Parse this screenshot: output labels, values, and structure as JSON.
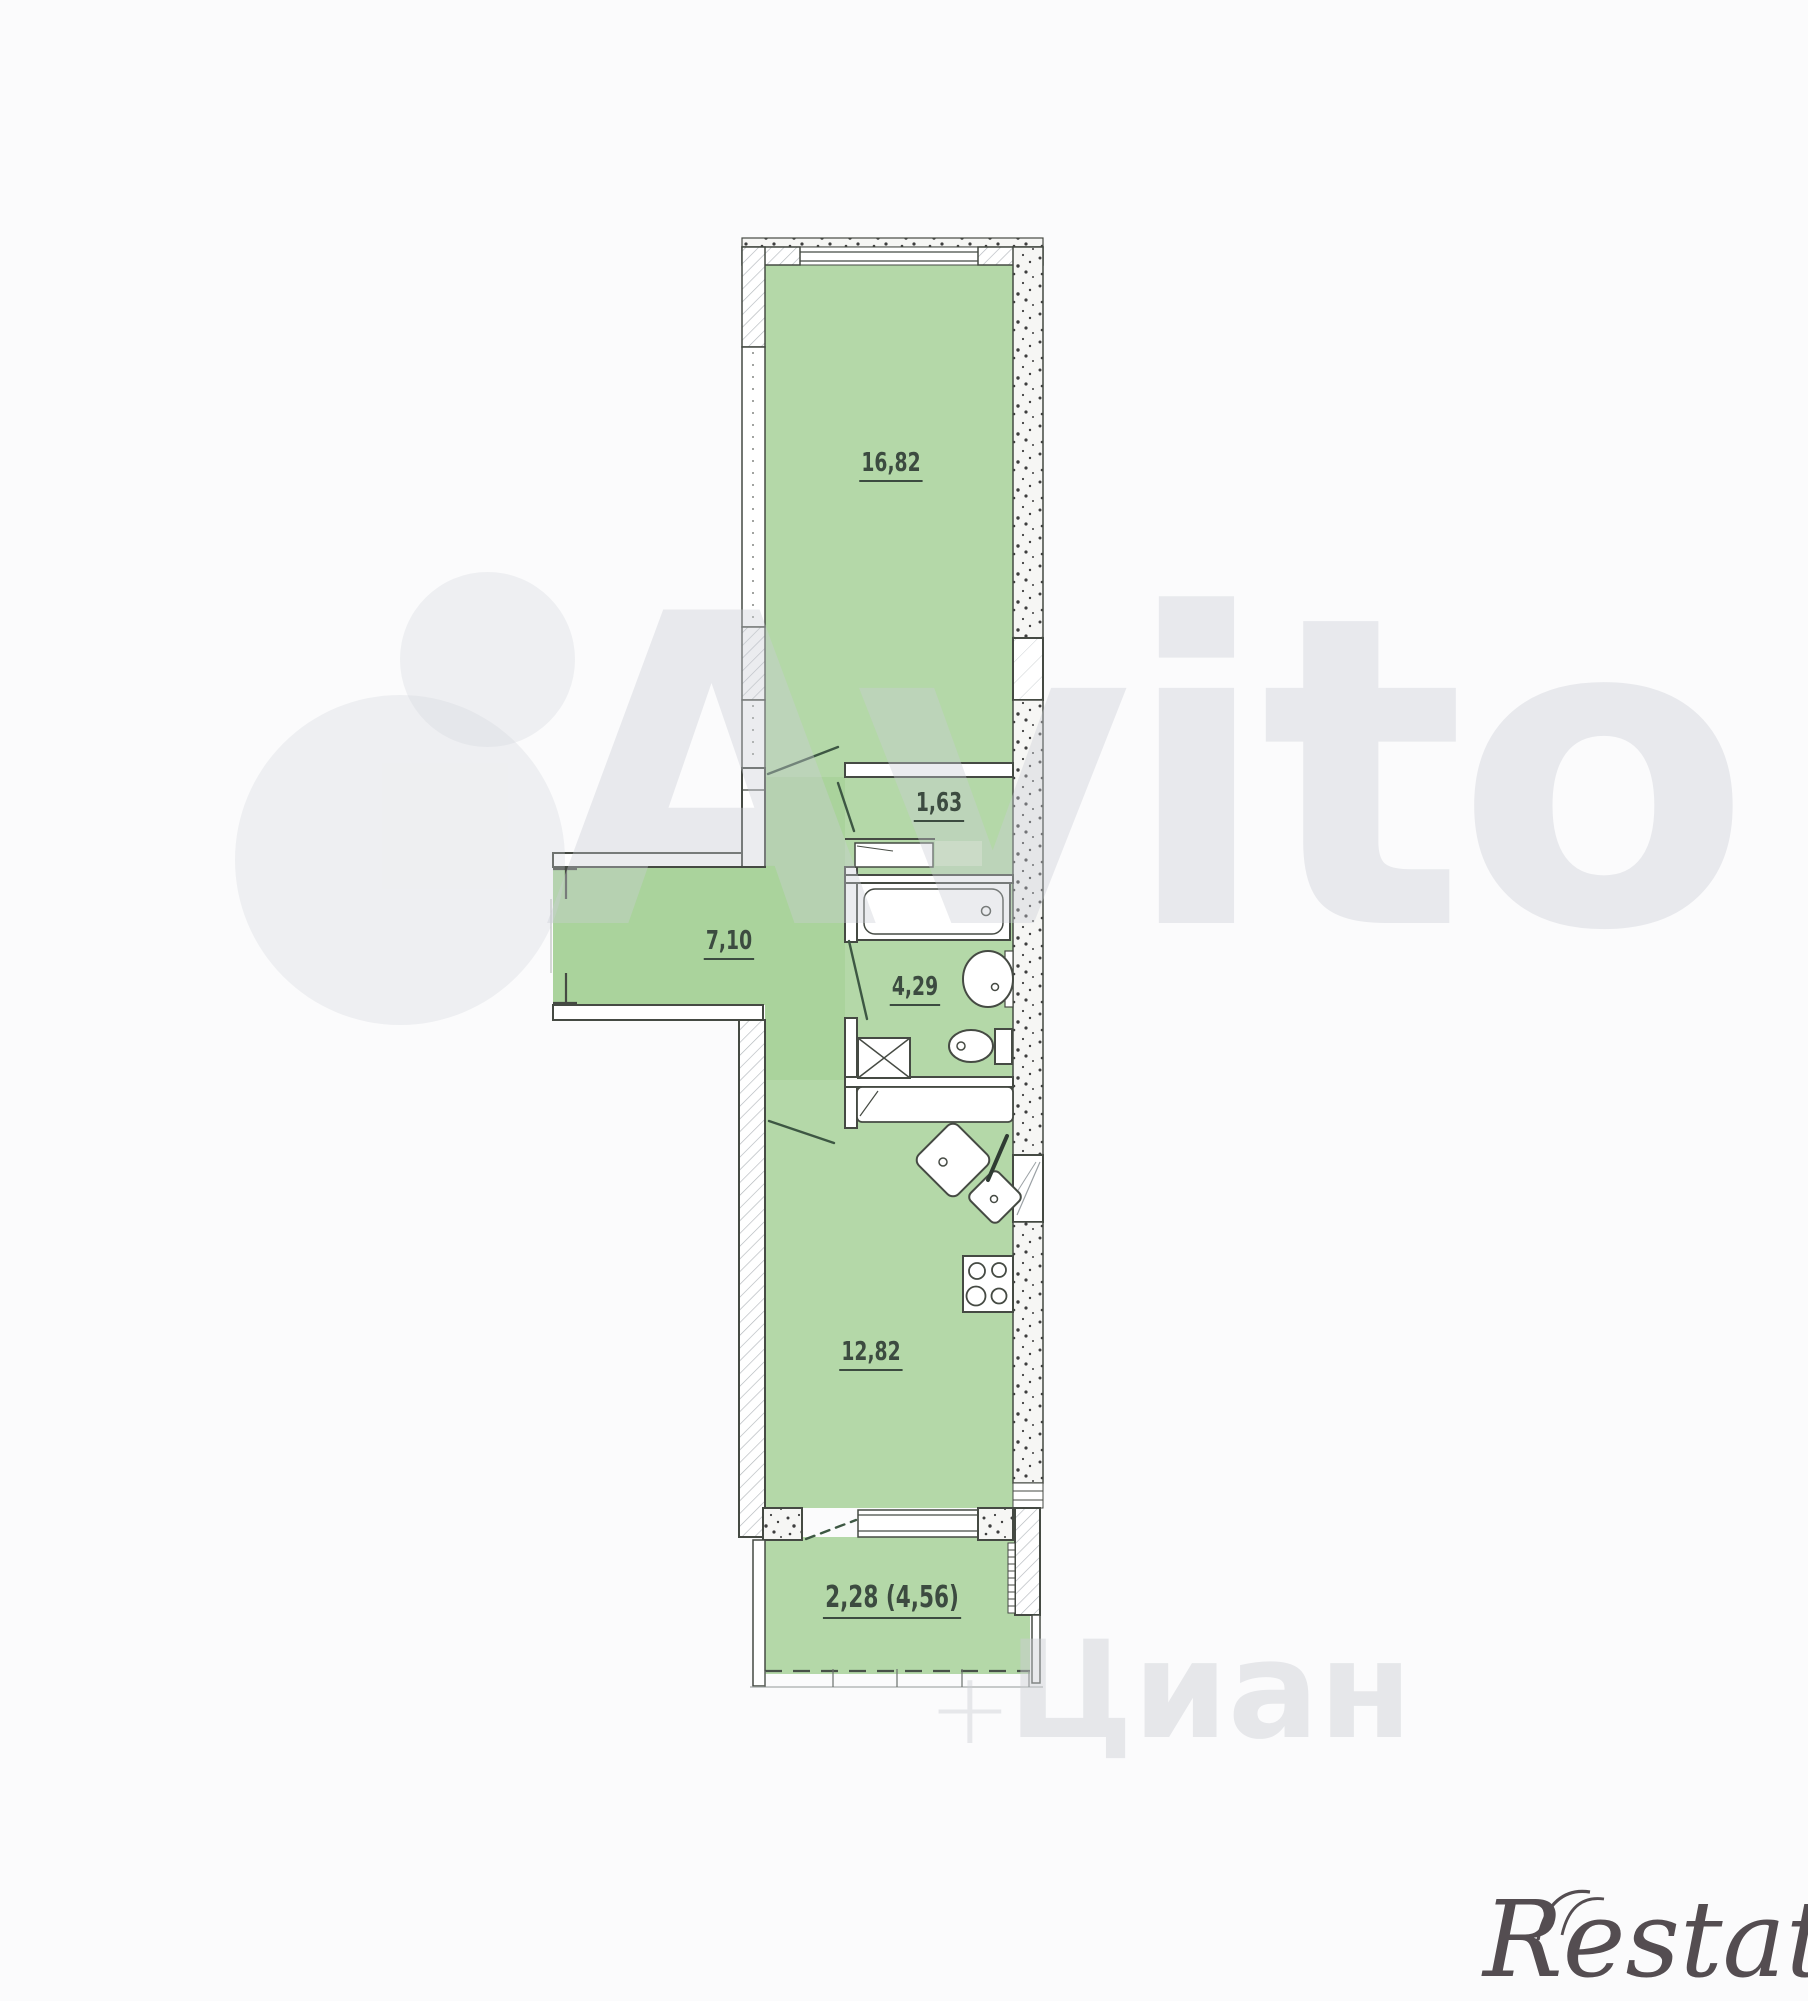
{
  "plan": {
    "area_labels": [
      {
        "id": "living-room",
        "label": "16,82"
      },
      {
        "id": "hall-small",
        "label": "1,63"
      },
      {
        "id": "corridor",
        "label": "7,10"
      },
      {
        "id": "bathroom",
        "label": "4,29"
      },
      {
        "id": "kitchen-living",
        "label": "12,82"
      },
      {
        "id": "balcony",
        "label": "2,28 (4,56)"
      }
    ],
    "colors": {
      "room_green": "#b4d8a8",
      "corridor_green": "#aad39c",
      "wardrobe_light_green": "#cbe4bf",
      "wall_line": "#454a43",
      "door_swing_green": "#3d5743",
      "label_text": "#3c4b40"
    }
  },
  "watermarks": {
    "avito": "Avito",
    "cian": "Циан",
    "cian_plus": "+",
    "restate": "Restate"
  }
}
